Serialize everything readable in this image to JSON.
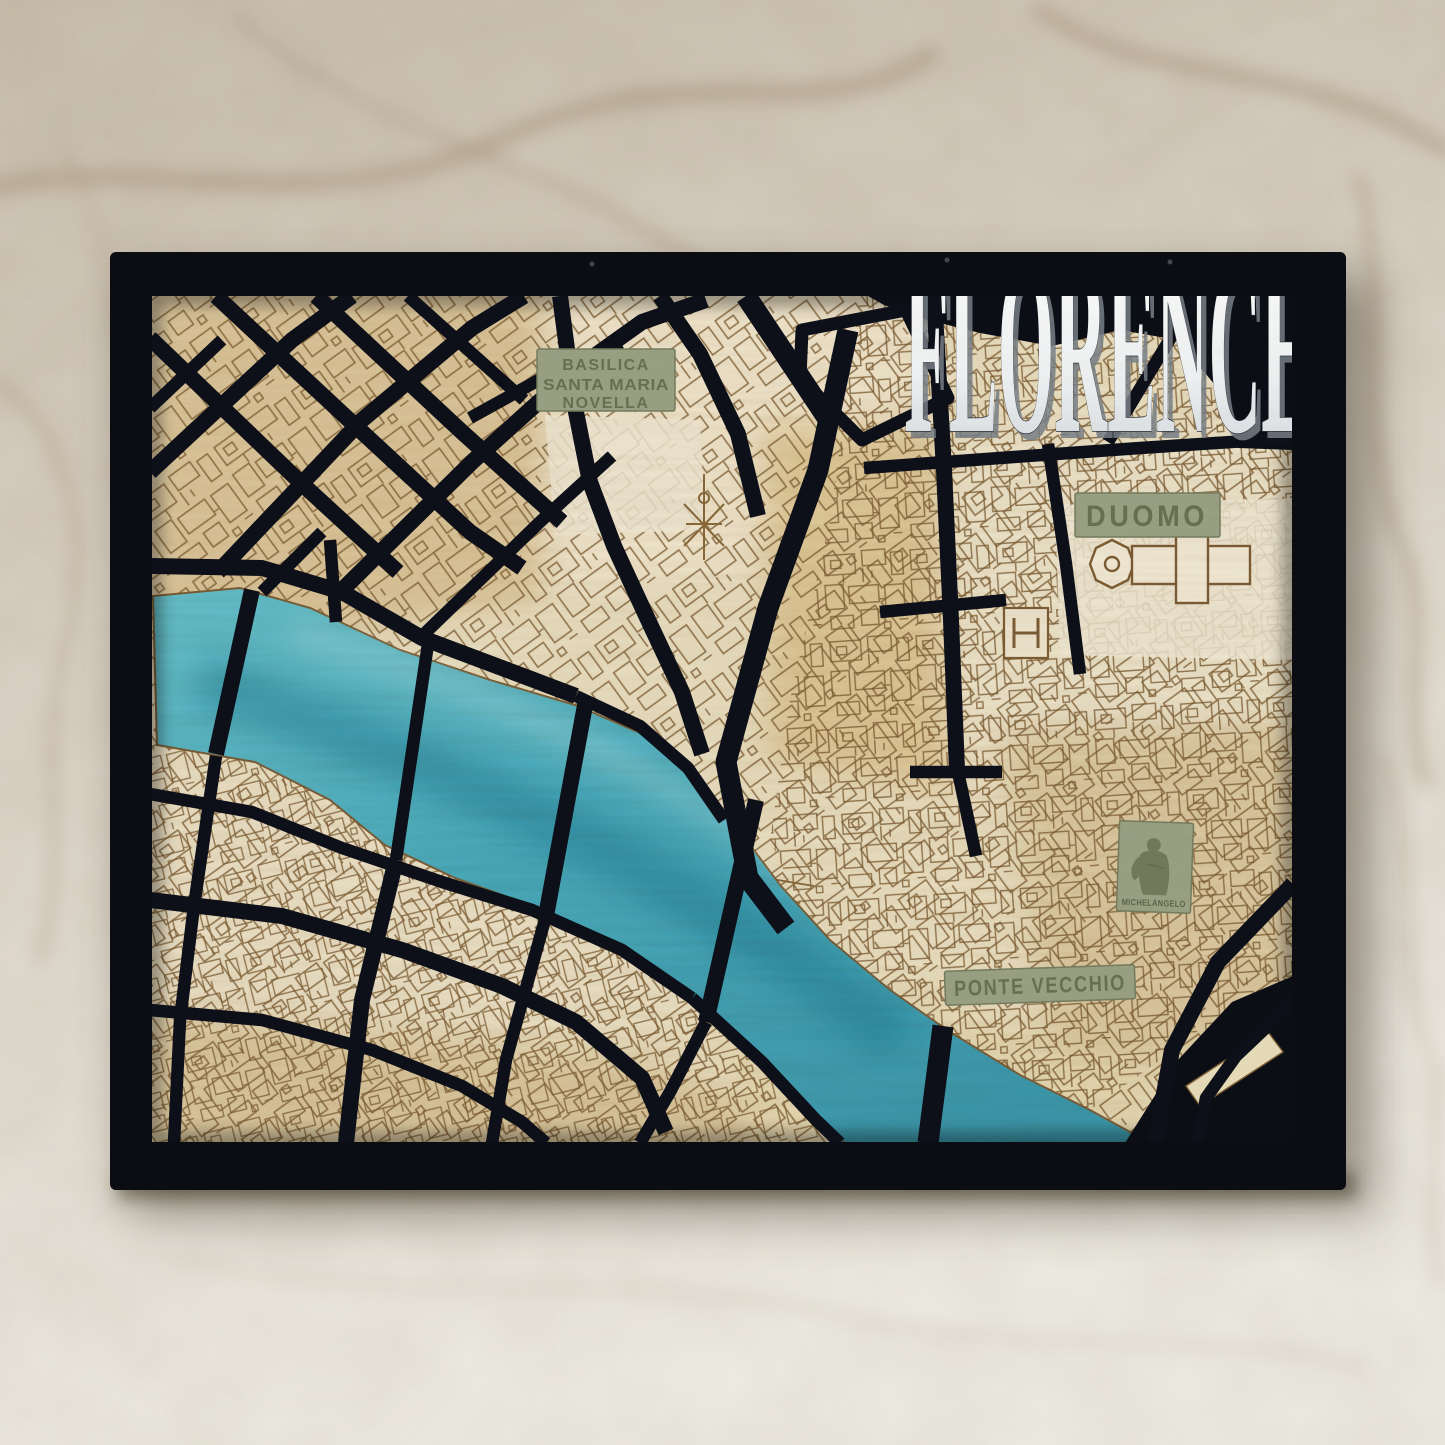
{
  "artwork": {
    "city_title": "FLORENCE",
    "plaques": {
      "basilica_line1": "BASILICA",
      "basilica_line2": "SANTA MARIA",
      "basilica_line3": "NOVELLA",
      "duomo": "DUOMO",
      "michelangelo": "MICHELANGELO",
      "ponte_vecchio": "PONTE VECCHIO"
    },
    "colors": {
      "frame_and_streets": "#0c0e15",
      "river": "#45a9bd",
      "wood_light": "#ece3c8",
      "wood_tan": "#d9c194",
      "engraving": "#7b5b31",
      "plaque": "#99a083",
      "plaque_text": "#68714f",
      "title": "#f4f6f7",
      "wall": "#d6cfc3"
    }
  }
}
